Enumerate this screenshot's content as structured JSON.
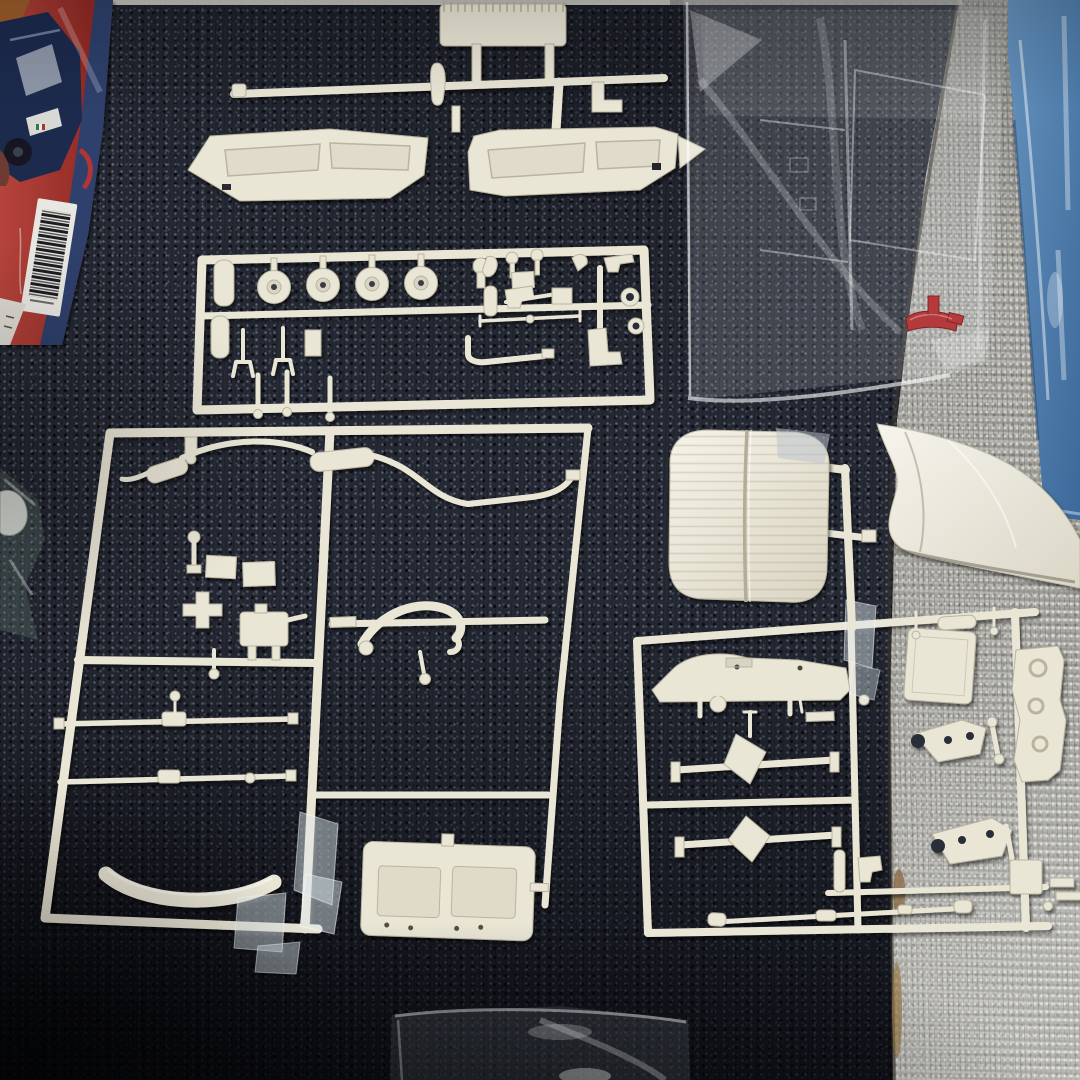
{
  "meta": {
    "alt": "Opened plastic model car kit laid out on a dark navy carpet next to gray loop-pile carpet: white part sprues, a tufted bench seat, a rear body panel, a sealed clear bag holding a windshield sprue and a small red part, a blue plastic-wrapped pack at the right edge, small sealed bags, and the corner of the kit box with car artwork and a barcode sticker."
  },
  "palette": {
    "navy_carpet": "#262a34",
    "navy_carpet_dark": "#17181f",
    "navy_speckle": "#5a6076",
    "gray_carpet": "#a5a49e",
    "gray_carpet_light": "#c2c0b8",
    "gray_carpet_shadow": "#807f7a",
    "sprue_ivory": "#eae6d6",
    "sprue_shadow": "#b9b4a0",
    "sprue_highlight": "#f7f4ea",
    "blue_bag": "#4e7dab",
    "blue_bag_light": "#86abce",
    "blue_bag_dark": "#355d8c",
    "red_part": "#b53a3c",
    "box_red": "#9e2f2a",
    "box_blue": "#2e3f6c",
    "box_car_blue": "#1e2a4e",
    "barcode_white": "#e9e7e1",
    "carpet_seam_brown": "#8a6b45"
  },
  "objects": {
    "navy_carpet": {
      "label": "dark navy carpet"
    },
    "gray_carpet": {
      "label": "gray loop-pile carpet"
    },
    "kit_box": {
      "label": "kit box corner with car artwork and barcode sticker"
    },
    "barcode": {
      "label": "barcode sticker"
    },
    "dashboard_sprue": {
      "label": "sprue with ribbed firewall part and two dashboard panels",
      "dashboard_panels": 2
    },
    "detail_sprue": {
      "label": "sprue with four wheel backs, valves and engine details",
      "wheel_backs": 4
    },
    "main_sprue": {
      "label": "large sprue with exhaust pipes, axle rods, curved bumper and ribbed floor panel"
    },
    "axle_sprue": {
      "label": "sprue with two rear axles, control arms and driveshaft",
      "rear_axles": 2
    },
    "bench_seat": {
      "label": "white tufted bench seat part"
    },
    "body_panel": {
      "label": "white rear body panel on gray carpet"
    },
    "clear_bag": {
      "label": "sealed clear bag with windshield sprue"
    },
    "red_part": {
      "label": "small red plastic part inside clear bag"
    },
    "blue_bag": {
      "label": "blue plastic-wrapped pack at right edge"
    },
    "bottom_bag": {
      "label": "small sealed clear bag at bottom edge"
    },
    "left_scrap": {
      "label": "folded bag scrap and white part at left edge"
    }
  }
}
